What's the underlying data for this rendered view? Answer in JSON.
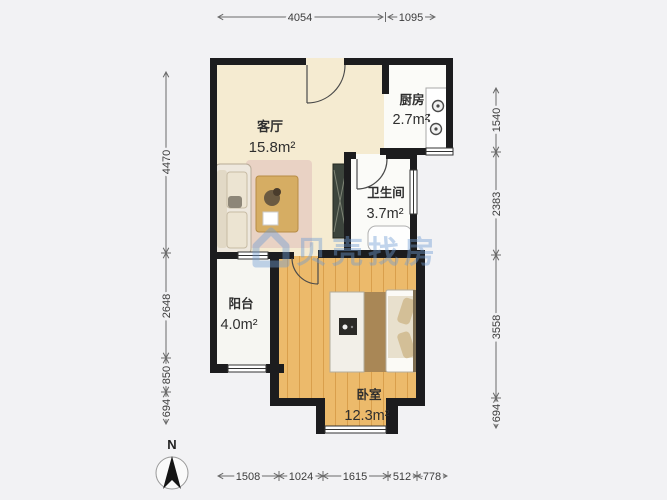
{
  "watermark": {
    "text": "贝壳找房"
  },
  "compass": {
    "label": "N"
  },
  "rooms": [
    {
      "name": "客厅",
      "area": "15.8m²"
    },
    {
      "name": "厨房",
      "area": "2.7m²"
    },
    {
      "name": "卫生间",
      "area": "3.7m²"
    },
    {
      "name": "阳台",
      "area": "4.0m²"
    },
    {
      "name": "卧室",
      "area": "12.3m²"
    }
  ],
  "dimensions": {
    "top": [
      "4054",
      "1095"
    ],
    "left": [
      "4470",
      "2648",
      "850",
      "694"
    ],
    "right": [
      "1540",
      "2383",
      "3558",
      "694"
    ],
    "bottom": [
      "1508",
      "1024",
      "1615",
      "512",
      "778"
    ]
  },
  "colors": {
    "background": "#f2f2f4",
    "wall": "#1c1c1e",
    "living_floor": "#f5ebd1",
    "wood_floor": "#ecba6b",
    "tile_floor": "#fbfbf8",
    "watermark_blue": "#6f9cd4"
  }
}
